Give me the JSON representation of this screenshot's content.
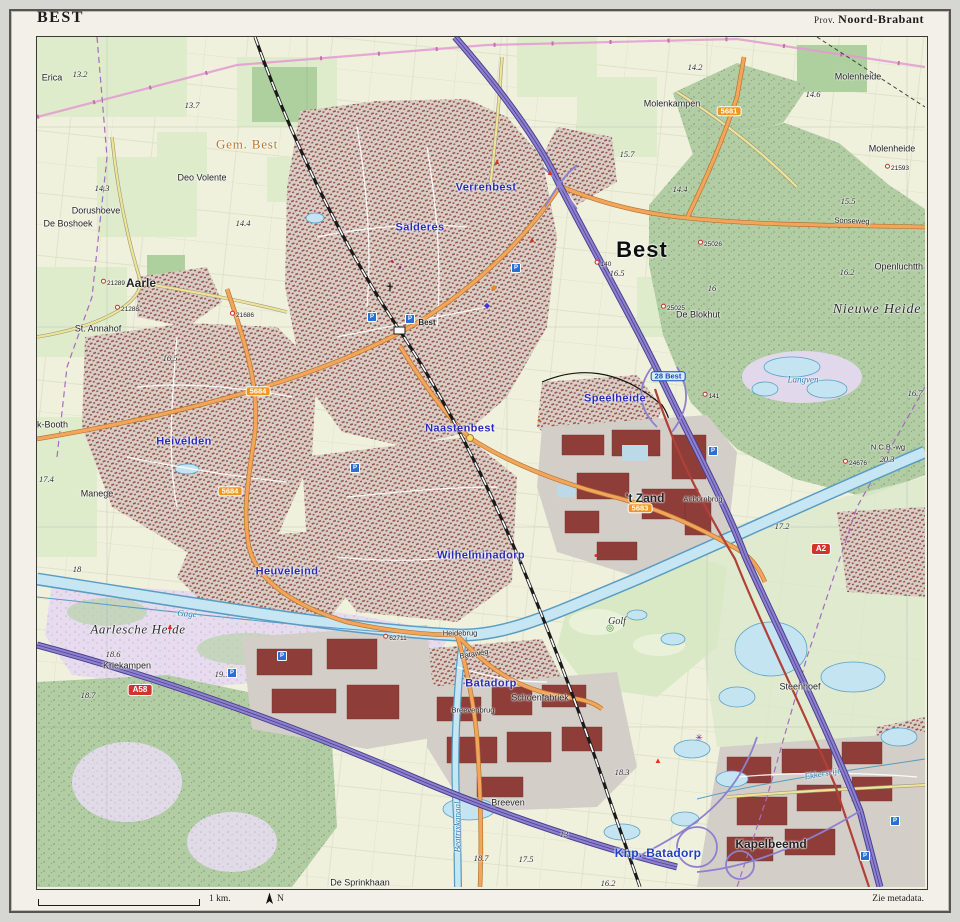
{
  "frame": {
    "title": "BEST",
    "province_prefix": "Prov.",
    "province": "Noord-Brabant",
    "scale_label": "1 km.",
    "north_label": "N",
    "metadata_note": "Zie metadata."
  },
  "colors": {
    "field": "#eff1dd",
    "meadow": "#dfeccb",
    "forest": "#b2cda4",
    "heath": "#e6dcee",
    "urban": "#d8cfc7",
    "building": "#9a4f49",
    "industrial_block": "#8e3d38",
    "water_fill": "#c6e6f4",
    "water_line": "#5a9cc2",
    "motorway": "#8d80cf",
    "road_orange": "#f3a55c",
    "road_yellow": "#f1e394",
    "n_road_red": "#b04038",
    "shield_red": "#d1342c",
    "shield_orange": "#ef9722",
    "quarter_label_blue": "#2a2ab8",
    "power_line_pink": "#e49ad2",
    "boundary_purple": "#a86ac0",
    "rail": "#1a1a1a",
    "gem_label": "#b5782f"
  },
  "map": {
    "labels": [
      {
        "text": "Best",
        "x": 605,
        "y": 213,
        "cls": "town"
      },
      {
        "text": "Aarle",
        "x": 104,
        "y": 246,
        "cls": "hamlet-bold"
      },
      {
        "text": "'t Zand",
        "x": 608,
        "y": 461,
        "cls": "zand"
      },
      {
        "text": "Kapelbeemd",
        "x": 734,
        "y": 807,
        "cls": "kap"
      },
      {
        "text": "Gem. Best",
        "x": 210,
        "y": 107,
        "cls": "gem"
      },
      {
        "text": "Verrenbest",
        "x": 449,
        "y": 151,
        "cls": "q"
      },
      {
        "text": "Salderes",
        "x": 383,
        "y": 191,
        "cls": "q"
      },
      {
        "text": "Heivelden",
        "x": 147,
        "y": 405,
        "cls": "q"
      },
      {
        "text": "Naastenbest",
        "x": 423,
        "y": 392,
        "cls": "q"
      },
      {
        "text": "Speelheide",
        "x": 578,
        "y": 362,
        "cls": "q"
      },
      {
        "text": "Wilhelminadorp",
        "x": 444,
        "y": 519,
        "cls": "q"
      },
      {
        "text": "Heuveleind",
        "x": 250,
        "y": 535,
        "cls": "q"
      },
      {
        "text": "Batadorp",
        "x": 454,
        "y": 647,
        "cls": "q"
      },
      {
        "text": "Knp. Batadorp",
        "x": 621,
        "y": 816,
        "cls": "knp"
      },
      {
        "text": "Erica",
        "x": 15,
        "y": 41,
        "cls": "place"
      },
      {
        "text": "Deo Volente",
        "x": 165,
        "y": 141,
        "cls": "place"
      },
      {
        "text": "Dorushoeve",
        "x": 59,
        "y": 174,
        "cls": "place"
      },
      {
        "text": "De Boshoek",
        "x": 31,
        "y": 187,
        "cls": "place"
      },
      {
        "text": "St. Annahof",
        "x": 61,
        "y": 292,
        "cls": "place"
      },
      {
        "text": "k-Booth",
        "x": 0,
        "y": 388,
        "cls": "place",
        "anchor": "start"
      },
      {
        "text": "Manege",
        "x": 60,
        "y": 457,
        "cls": "place"
      },
      {
        "text": "Kriekampen",
        "x": 90,
        "y": 629,
        "cls": "place"
      },
      {
        "text": "Molenkampen",
        "x": 635,
        "y": 67,
        "cls": "place"
      },
      {
        "text": "Molenheide",
        "x": 821,
        "y": 40,
        "cls": "place"
      },
      {
        "text": "Molenheide",
        "x": 855,
        "y": 112,
        "cls": "place"
      },
      {
        "text": "De Blokhut",
        "x": 661,
        "y": 278,
        "cls": "place"
      },
      {
        "text": "Openluchtth",
        "x": 886,
        "y": 230,
        "cls": "place",
        "anchor": "end"
      },
      {
        "text": "Steenhoef",
        "x": 763,
        "y": 650,
        "cls": "place"
      },
      {
        "text": "Schoenfabriek",
        "x": 503,
        "y": 661,
        "cls": "place"
      },
      {
        "text": "Breeven",
        "x": 471,
        "y": 766,
        "cls": "place"
      },
      {
        "text": "De Sprinkhaan",
        "x": 323,
        "y": 846,
        "cls": "place"
      },
      {
        "text": "Best",
        "x": 390,
        "y": 286,
        "cls": "tiny-bold"
      },
      {
        "text": "Heidebrug",
        "x": 423,
        "y": 596,
        "cls": "tiny"
      },
      {
        "text": "Breevenbrug",
        "x": 436,
        "y": 673,
        "cls": "tiny"
      },
      {
        "text": "Airbornbrug",
        "x": 666,
        "y": 462,
        "cls": "tiny"
      },
      {
        "text": "N.C.B.-wg",
        "x": 851,
        "y": 410,
        "cls": "tiny"
      },
      {
        "text": "Sonseweg",
        "x": 815,
        "y": 184,
        "cls": "tiny",
        "rot": 2
      },
      {
        "text": "Bataweg",
        "x": 437,
        "y": 617,
        "cls": "tiny",
        "rot": -10
      },
      {
        "text": "Aarlesche Heide",
        "x": 101,
        "y": 592,
        "cls": "area"
      },
      {
        "text": "Nieuwe Heide",
        "x": 840,
        "y": 273,
        "cls": "area-big"
      },
      {
        "text": "Golf",
        "x": 580,
        "y": 585,
        "cls": "golf"
      },
      {
        "text": "Langven",
        "x": 766,
        "y": 343,
        "cls": "water"
      },
      {
        "text": "Ekkersrijt",
        "x": 785,
        "y": 737,
        "cls": "water",
        "rot": -10
      },
      {
        "text": "Beatrixkanaal",
        "x": 421,
        "y": 790,
        "cls": "water",
        "rot": -90
      },
      {
        "text": "Gage",
        "x": 150,
        "y": 577,
        "cls": "water",
        "rot": 4
      },
      {
        "text": "13.2",
        "x": 43,
        "y": 37,
        "cls": "elev"
      },
      {
        "text": "13.7",
        "x": 155,
        "y": 68,
        "cls": "elev"
      },
      {
        "text": "14.3",
        "x": 65,
        "y": 151,
        "cls": "elev"
      },
      {
        "text": "14.4",
        "x": 206,
        "y": 186,
        "cls": "elev"
      },
      {
        "text": "14.4",
        "x": 643,
        "y": 152,
        "cls": "elev"
      },
      {
        "text": "15.7",
        "x": 590,
        "y": 117,
        "cls": "elev"
      },
      {
        "text": "14.2",
        "x": 658,
        "y": 30,
        "cls": "elev"
      },
      {
        "text": "14.6",
        "x": 776,
        "y": 57,
        "cls": "elev"
      },
      {
        "text": "15.5",
        "x": 811,
        "y": 164,
        "cls": "elev"
      },
      {
        "text": "16.2",
        "x": 810,
        "y": 235,
        "cls": "elev"
      },
      {
        "text": "16",
        "x": 675,
        "y": 251,
        "cls": "elev"
      },
      {
        "text": "16.5",
        "x": 580,
        "y": 236,
        "cls": "elev"
      },
      {
        "text": "16.5",
        "x": 133,
        "y": 321,
        "cls": "elev"
      },
      {
        "text": "17.4",
        "x": 2,
        "y": 442,
        "cls": "elev",
        "anchor": "start"
      },
      {
        "text": "18",
        "x": 40,
        "y": 532,
        "cls": "elev"
      },
      {
        "text": "18.6",
        "x": 76,
        "y": 617,
        "cls": "elev"
      },
      {
        "text": "19.1",
        "x": 185,
        "y": 637,
        "cls": "elev"
      },
      {
        "text": "18.7",
        "x": 51,
        "y": 658,
        "cls": "elev"
      },
      {
        "text": "17.2",
        "x": 745,
        "y": 489,
        "cls": "elev"
      },
      {
        "text": "20.3",
        "x": 850,
        "y": 422,
        "cls": "elev"
      },
      {
        "text": "16.7",
        "x": 878,
        "y": 356,
        "cls": "elev"
      },
      {
        "text": "18.3",
        "x": 585,
        "y": 735,
        "cls": "elev"
      },
      {
        "text": "18.7",
        "x": 444,
        "y": 821,
        "cls": "elev"
      },
      {
        "text": "17.5",
        "x": 489,
        "y": 822,
        "cls": "elev"
      },
      {
        "text": "13",
        "x": 527,
        "y": 797,
        "cls": "elev"
      },
      {
        "text": "16.2",
        "x": 571,
        "y": 846,
        "cls": "elev"
      },
      {
        "text": "21289",
        "x": 76,
        "y": 246,
        "cls": "mark"
      },
      {
        "text": "21288",
        "x": 90,
        "y": 272,
        "cls": "mark"
      },
      {
        "text": "21686",
        "x": 205,
        "y": 278,
        "cls": "mark"
      },
      {
        "text": "21593",
        "x": 860,
        "y": 131,
        "cls": "mark"
      },
      {
        "text": "25026",
        "x": 673,
        "y": 207,
        "cls": "mark"
      },
      {
        "text": "25025",
        "x": 636,
        "y": 271,
        "cls": "mark"
      },
      {
        "text": "62711",
        "x": 358,
        "y": 601,
        "cls": "mark"
      },
      {
        "text": "24676",
        "x": 818,
        "y": 426,
        "cls": "mark"
      },
      {
        "text": "141",
        "x": 674,
        "y": 359,
        "cls": "mark"
      },
      {
        "text": "140",
        "x": 566,
        "y": 227,
        "cls": "mark"
      },
      {
        "text": "A58",
        "x": 103,
        "y": 653,
        "cls": "sh-red"
      },
      {
        "text": "A2",
        "x": 784,
        "y": 512,
        "cls": "sh-red"
      },
      {
        "text": "5683",
        "x": 603,
        "y": 471,
        "cls": "sh-or"
      },
      {
        "text": "5684",
        "x": 221,
        "y": 354,
        "cls": "sh-or"
      },
      {
        "text": "5684",
        "x": 193,
        "y": 454,
        "cls": "sh-or"
      },
      {
        "text": "5681",
        "x": 692,
        "y": 74,
        "cls": "sh-or"
      },
      {
        "text": "28 Best",
        "x": 631,
        "y": 339,
        "cls": "exit"
      }
    ],
    "icons": [
      {
        "name": "church-icon",
        "glyph": "✝",
        "color": "#1a1a1a",
        "x": 353,
        "y": 252,
        "size": 11
      },
      {
        "name": "parking-icon",
        "glyph": "P",
        "bg": "#2a6fd4",
        "x": 335,
        "y": 280
      },
      {
        "name": "parking-icon",
        "glyph": "P",
        "bg": "#2a6fd4",
        "x": 373,
        "y": 282
      },
      {
        "name": "parking-icon",
        "glyph": "P",
        "bg": "#2a6fd4",
        "x": 479,
        "y": 231
      },
      {
        "name": "parking-icon",
        "glyph": "P",
        "bg": "#2a6fd4",
        "x": 318,
        "y": 431
      },
      {
        "name": "parking-icon",
        "glyph": "P",
        "bg": "#2a6fd4",
        "x": 245,
        "y": 619
      },
      {
        "name": "parking-icon",
        "glyph": "P",
        "bg": "#2a6fd4",
        "x": 195,
        "y": 636
      },
      {
        "name": "parking-icon",
        "glyph": "P",
        "bg": "#2a6fd4",
        "x": 676,
        "y": 414
      },
      {
        "name": "parking-icon",
        "glyph": "P",
        "bg": "#2a6fd4",
        "x": 858,
        "y": 784
      },
      {
        "name": "parking-icon",
        "glyph": "P",
        "bg": "#2a6fd4",
        "x": 828,
        "y": 819
      },
      {
        "name": "campsite-icon",
        "glyph": "▲",
        "color": "#e03020",
        "x": 513,
        "y": 136,
        "size": 8
      },
      {
        "name": "campsite-icon",
        "glyph": "▲",
        "color": "#e03020",
        "x": 460,
        "y": 125,
        "size": 8
      },
      {
        "name": "campsite-icon",
        "glyph": "▲",
        "color": "#e03020",
        "x": 495,
        "y": 203,
        "size": 8
      },
      {
        "name": "campsite-icon",
        "glyph": "▲",
        "color": "#e03020",
        "x": 133,
        "y": 590,
        "size": 8
      },
      {
        "name": "campsite-icon",
        "glyph": "▲",
        "color": "#e03020",
        "x": 621,
        "y": 724,
        "size": 8
      },
      {
        "name": "windmill-icon",
        "glyph": "✳",
        "color": "#7a1fa0",
        "x": 662,
        "y": 701,
        "size": 9
      },
      {
        "name": "monument-icon",
        "glyph": "◆",
        "color": "#e8891c",
        "x": 457,
        "y": 251,
        "size": 8
      },
      {
        "name": "poi-icon",
        "glyph": "◆",
        "color": "#4433cc",
        "x": 450,
        "y": 269,
        "size": 8
      },
      {
        "name": "museum-icon",
        "glyph": "●",
        "color": "#c2185b",
        "x": 355,
        "y": 225,
        "size": 6
      },
      {
        "name": "poi-icon",
        "glyph": "●",
        "color": "#7b1fa2",
        "x": 363,
        "y": 231,
        "size": 6
      },
      {
        "name": "hospital-icon",
        "glyph": "●",
        "color": "#d32f2f",
        "x": 559,
        "y": 519,
        "size": 7
      },
      {
        "name": "poi-icon",
        "glyph": "●",
        "color": "#e65100",
        "x": 502,
        "y": 384,
        "size": 6
      },
      {
        "name": "golf-icon",
        "glyph": "◎",
        "color": "#2e7d32",
        "x": 573,
        "y": 591,
        "size": 9
      }
    ]
  }
}
